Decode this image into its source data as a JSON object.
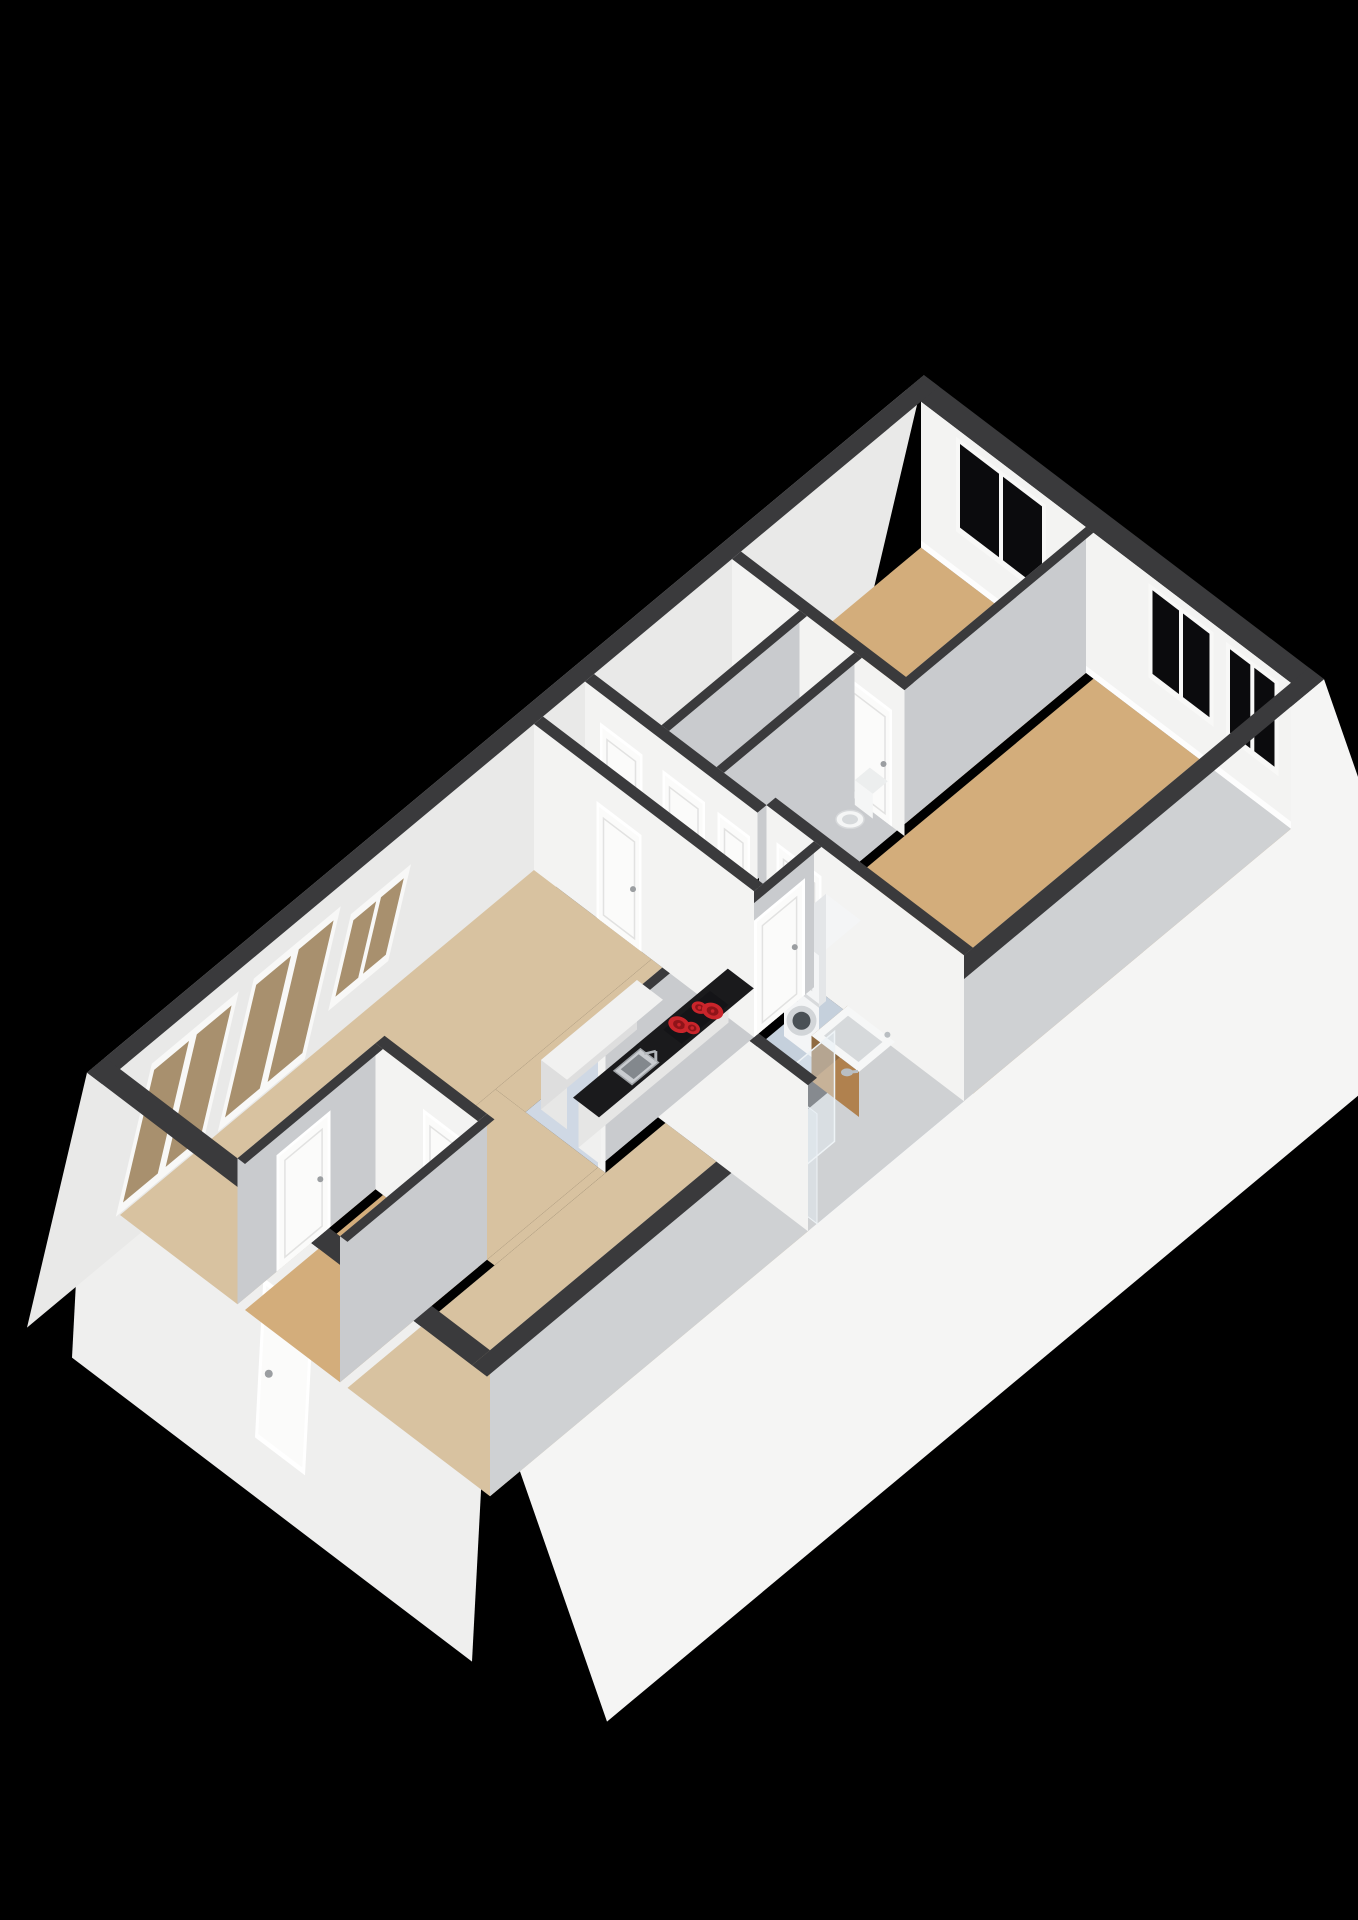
{
  "scene": {
    "background": "#000000",
    "kind": "3d-axonometric-floorplan-render"
  },
  "colors": {
    "background": "#000000",
    "wall_top": "#3a3a3c",
    "ext_face_east": "#f5f5f4",
    "ext_face_south": "#efefee",
    "ext_face_west": "#e9e9e8",
    "int_face_bright": "#f3f3f2",
    "int_face_shaded": "#c9cbce",
    "east_inner": "#cfd1d3",
    "baseboard": "#fdfdfd",
    "floor_living": "#d8c2a0",
    "floor_bedroom": "#d3ad7b",
    "floor_storage": "#e2e3e5",
    "floor_toilet": "#a9aeb3",
    "floor_bathroom": "#c5d0dc",
    "floor_kitchen": "#cfd8e4",
    "door_leaf": "#fbfbfa",
    "door_frame": "#ffffff",
    "door_trim": "#e2e2e1",
    "door_handle": "#9b9ea1",
    "window_frame": "#f8f8f7",
    "window_pane": "#0b0b0d",
    "glass_door_pane": "#a8906e",
    "counter_top": "#1a1a1c",
    "cabinet_front": "#f0f0ef",
    "cabinet_side": "#e6e6e5",
    "island_top": "#f1f1f0",
    "island_front": "#e7e7e6",
    "island_side": "#dedede",
    "cooktop": "#141417",
    "burner_red": "#c9252b",
    "burner_core": "#8e1419",
    "sink_steel": "#c9ccd0",
    "sink_rim": "#9fa3a7",
    "sink_basin": "#83888d",
    "faucet": "#b4b8bc",
    "washer_body": "#f4f5f6",
    "washer_side": "#e4e6e8",
    "washer_detail": "#d8dadc",
    "washer_ring": "#d2d5d8",
    "washer_door": "#4a5055",
    "vanity_wood": "#b0814e",
    "vanity_wood_dark": "#8f6a41",
    "basin_top": "#f6f7f7",
    "basin_inner": "#d6d9db",
    "shower_glass": "rgba(228,238,245,0.45)",
    "shower_glass_edge": "#eef3f6",
    "shower_fitting": "#b9bec2",
    "toilet_white": "#f5f6f6",
    "toilet_rim": "#d7d9db",
    "meter_inside": "#3a3c3e",
    "meter_frame": "#f4f4f4",
    "meter_side": "#e9e9e8",
    "meter_bar_red": "#6f1d22",
    "meter_bar_dark": "#202124"
  },
  "rooms": [
    {
      "id": "living-room",
      "floor": "floor_living"
    },
    {
      "id": "kitchen",
      "floor": "floor_kitchen"
    },
    {
      "id": "corridor",
      "floor": "floor_living"
    },
    {
      "id": "entrance-hall",
      "floor": "floor_bedroom"
    },
    {
      "id": "bedroom-1",
      "floor": "floor_bedroom"
    },
    {
      "id": "bedroom-2",
      "floor": "floor_bedroom"
    },
    {
      "id": "bathroom",
      "floor": "floor_bathroom"
    },
    {
      "id": "toilet-room",
      "floor": "floor_toilet"
    },
    {
      "id": "storage-1",
      "floor": "floor_storage"
    },
    {
      "id": "storage-2",
      "floor": "floor_storage"
    }
  ],
  "fixtures": [
    {
      "id": "kitchen-counter"
    },
    {
      "id": "kitchen-sink"
    },
    {
      "id": "cooktop",
      "burners": 4
    },
    {
      "id": "kitchen-island"
    },
    {
      "id": "washer-dryer-stack"
    },
    {
      "id": "bathroom-vanity"
    },
    {
      "id": "shower"
    },
    {
      "id": "shower-head"
    },
    {
      "id": "toilet-bowl"
    },
    {
      "id": "meter-cupboard"
    }
  ],
  "openings": {
    "north_wall_windows": 3,
    "west_facade_glass_doors": 2,
    "west_facade_windows": 1,
    "front_door": 1,
    "interior_doors": 9
  }
}
